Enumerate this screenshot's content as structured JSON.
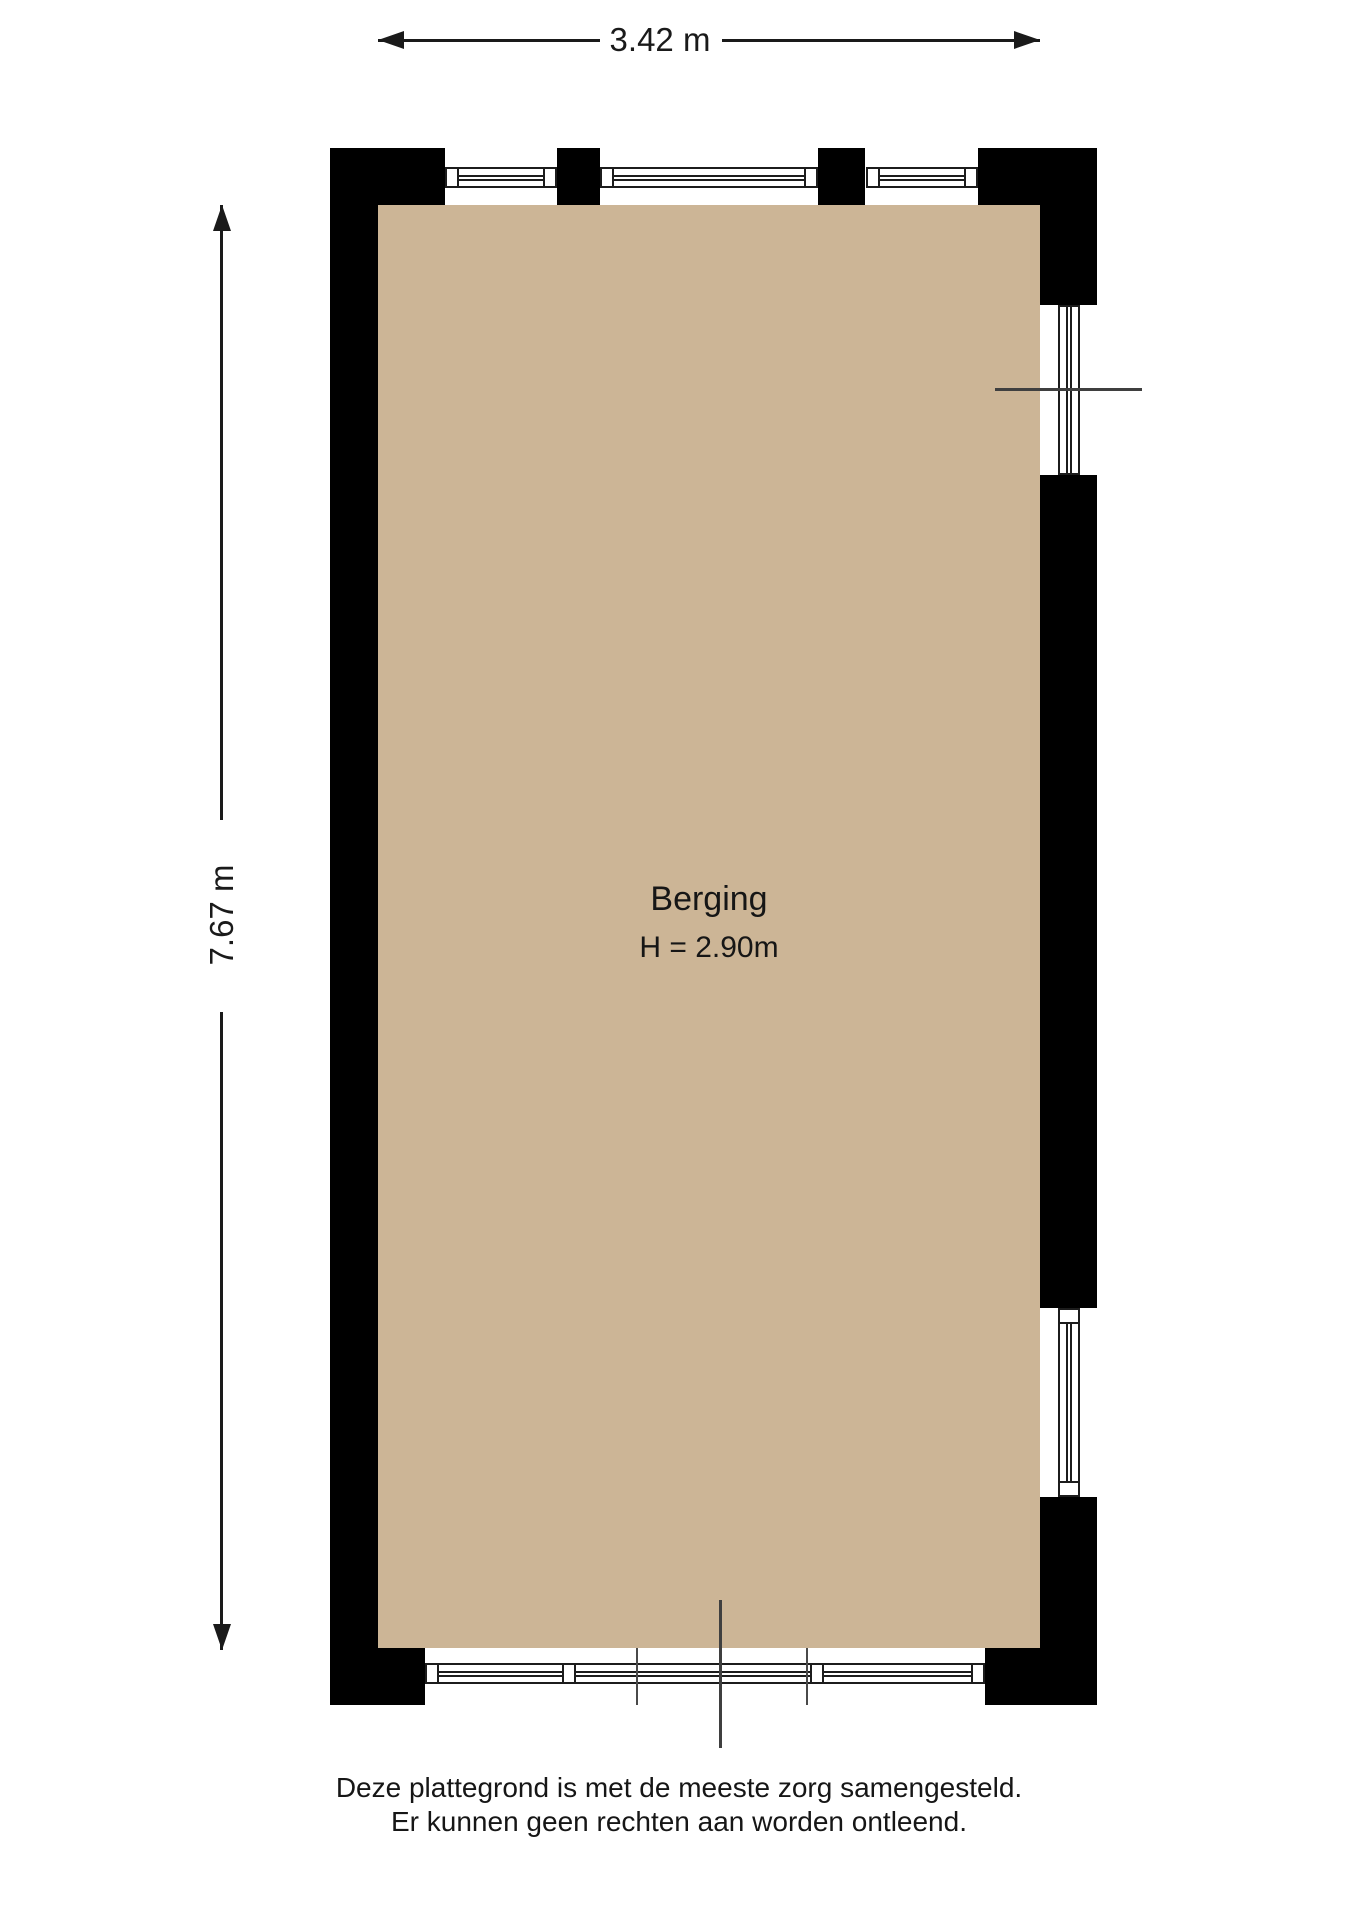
{
  "plan": {
    "dimensions": {
      "width_label": "3.42 m",
      "height_label": "7.67 m"
    },
    "room": {
      "label": "Berging",
      "ceiling_height": "H = 2.90m"
    },
    "disclaimer": {
      "line1": "Deze plattegrond is met de meeste zorg samengesteld.",
      "line2": "Er kunnen geen rechten aan worden ontleend."
    },
    "colors": {
      "floor": "#ccb596",
      "wall": "#000000",
      "line": "#1a1a1a",
      "frame": "#1c1c1c",
      "ref": "#3f3f3f"
    }
  }
}
